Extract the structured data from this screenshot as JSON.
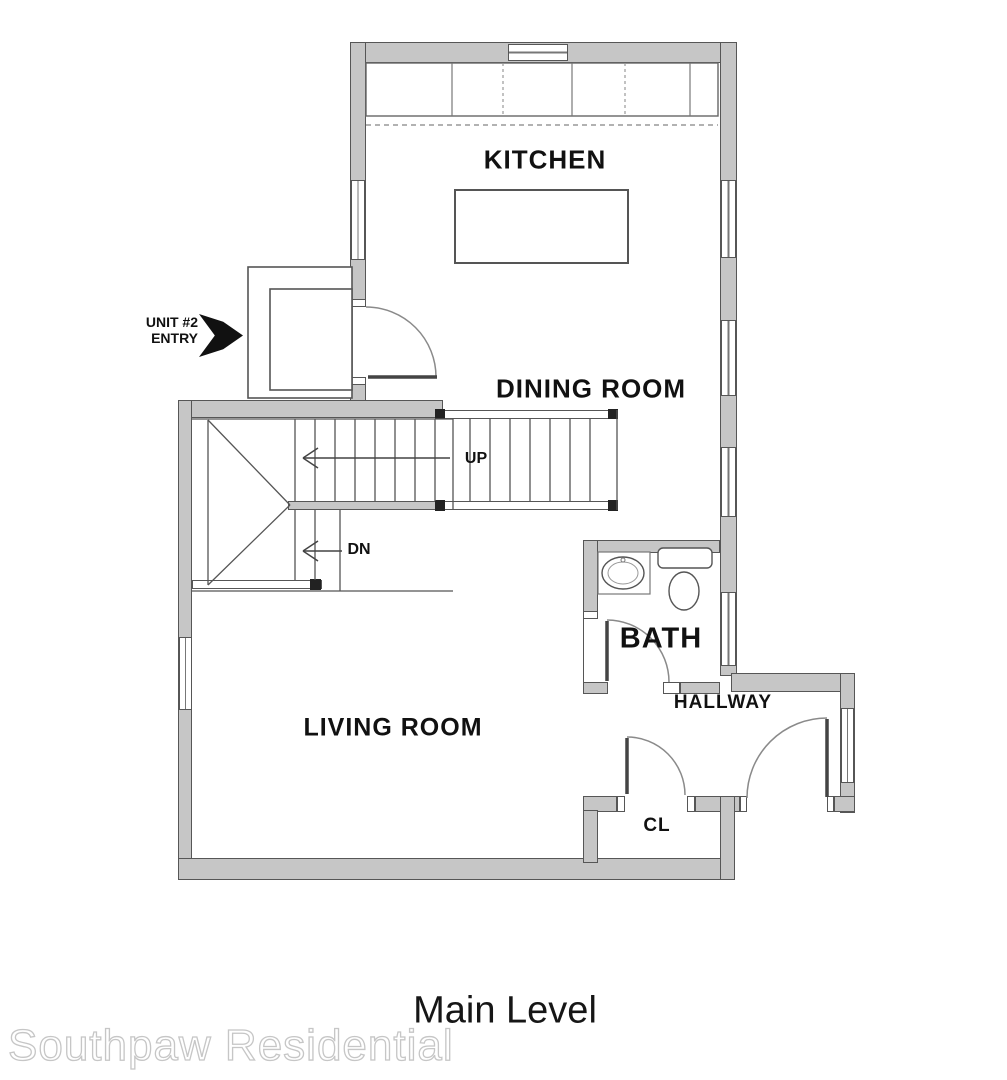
{
  "title": "Main Level",
  "watermark": "Southpaw Residential",
  "rooms": {
    "kitchen": "KITCHEN",
    "dining": "DINING ROOM",
    "living": "LIVING ROOM",
    "bath": "BATH",
    "hallway": "HALLWAY",
    "closet": "CL"
  },
  "stairs": {
    "up": "UP",
    "down": "DN"
  },
  "entry": {
    "line1": "UNIT #2",
    "line2": "ENTRY"
  },
  "colors": {
    "wall": "#c6c6c6",
    "wall-edge": "#565656",
    "line": "#555555",
    "arc": "#8a8a8a",
    "text": "#111111",
    "watermark": "#c6c6c6"
  }
}
